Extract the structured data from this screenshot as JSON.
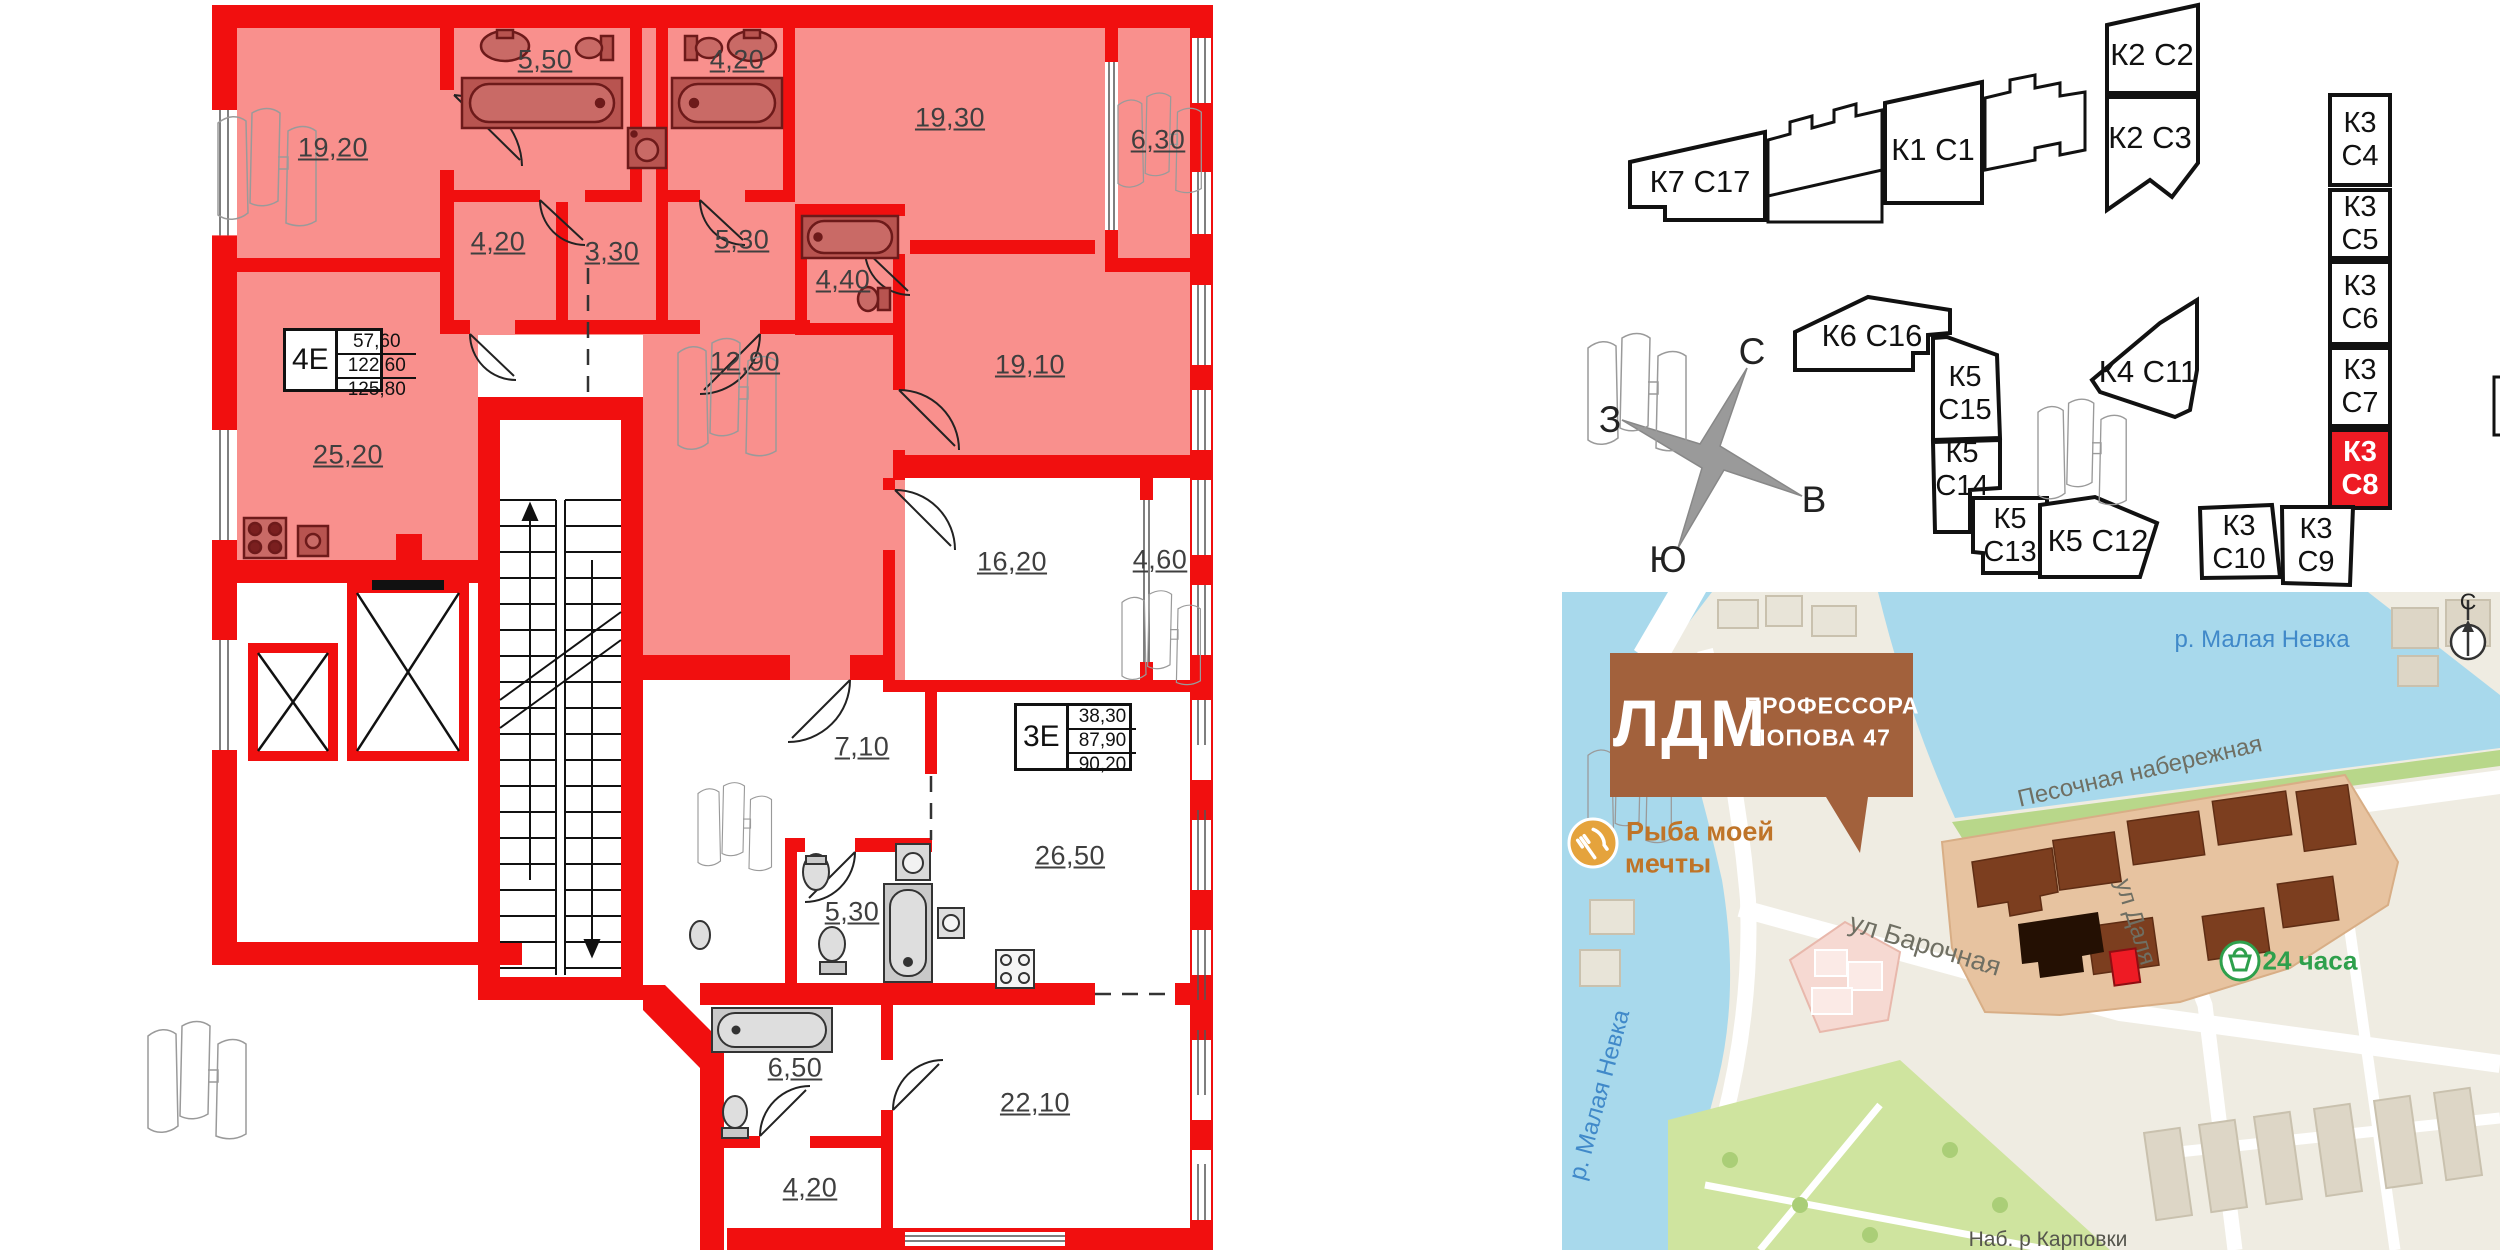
{
  "plan": {
    "unit_top": {
      "code": "4Е",
      "area_rows": [
        "57,60",
        "122,60",
        "125,80"
      ],
      "rooms": {
        "living": "19,20",
        "bath_a": "5,50",
        "bath_b": "4,20",
        "bedroom": "19,30",
        "balcony": "6,30",
        "hall_a": "4,20",
        "laundry": "3,30",
        "hall_b": "5,30",
        "bath_c": "4,40",
        "room_right": "19,10",
        "kitchen": "25,20",
        "corridor": "12,90"
      }
    },
    "unit_bottom": {
      "code": "3Е",
      "area_rows": [
        "38,30",
        "87,90",
        "90,20"
      ],
      "rooms": {
        "bedroom": "16,20",
        "balcony": "4,60",
        "hall": "7,10",
        "kitchen_living": "26,50",
        "bath": "5,30",
        "bath_b": "6,50",
        "hall_b": "4,20",
        "room": "22,10"
      }
    }
  },
  "site": {
    "highlight_color": "#ee1b24",
    "compass": {
      "north": "С",
      "east": "В",
      "south": "Ю",
      "west": "З"
    },
    "buildings": {
      "k7c17": {
        "label": "К7 С17"
      },
      "k1c1": {
        "label": "К1 С1"
      },
      "k2c2": {
        "label": "К2 С2"
      },
      "k2c3": {
        "label": "К2 С3"
      },
      "k6c16": {
        "label": "К6 С16"
      },
      "k5c15": {
        "line1": "К5",
        "line2": "С15"
      },
      "k5c14": {
        "line1": "К5",
        "line2": "С14"
      },
      "k5c13": {
        "line1": "К5",
        "line2": "С13"
      },
      "k5c12": {
        "label": "К5 С12"
      },
      "k4c11": {
        "label": "К4 С11"
      },
      "k3c4": {
        "line1": "К3",
        "line2": "С4"
      },
      "k3c5": {
        "line1": "К3",
        "line2": "С5"
      },
      "k3c6": {
        "line1": "К3",
        "line2": "С6"
      },
      "k3c7": {
        "line1": "К3",
        "line2": "С7"
      },
      "k3c8": {
        "line1": "К3",
        "line2": "С8",
        "selected": true
      },
      "k3c10": {
        "line1": "К3",
        "line2": "С10"
      },
      "k3c9": {
        "line1": "К3",
        "line2": "С9"
      }
    }
  },
  "map": {
    "callout": {
      "title": "ЛДМ",
      "subtitle_line1": "ПРОФЕССОРА",
      "subtitle_line2": "ПОПОВА 47",
      "color": "#a2613c"
    },
    "poi_restaurant": {
      "line1": "Рыба моей",
      "line2": "мечты"
    },
    "poi_store": {
      "label": "24 часа"
    },
    "labels": {
      "river_top": "р. Малая Невка",
      "river_left": "р. Малая Невка",
      "embankment": "Песочная набережная",
      "street_dalya": "ул Даля",
      "street_barochnaya": "ул Барочная",
      "embankment_bottom": "Наб. р Карповки",
      "north": "С"
    }
  },
  "colors": {
    "wall": "#f10f0f",
    "unit_fill": "#f9908d",
    "fixture": "#b85450",
    "water": "#a8d9ec",
    "site_area": "#e7c3a0",
    "building_brown": "#7c3e1f"
  }
}
